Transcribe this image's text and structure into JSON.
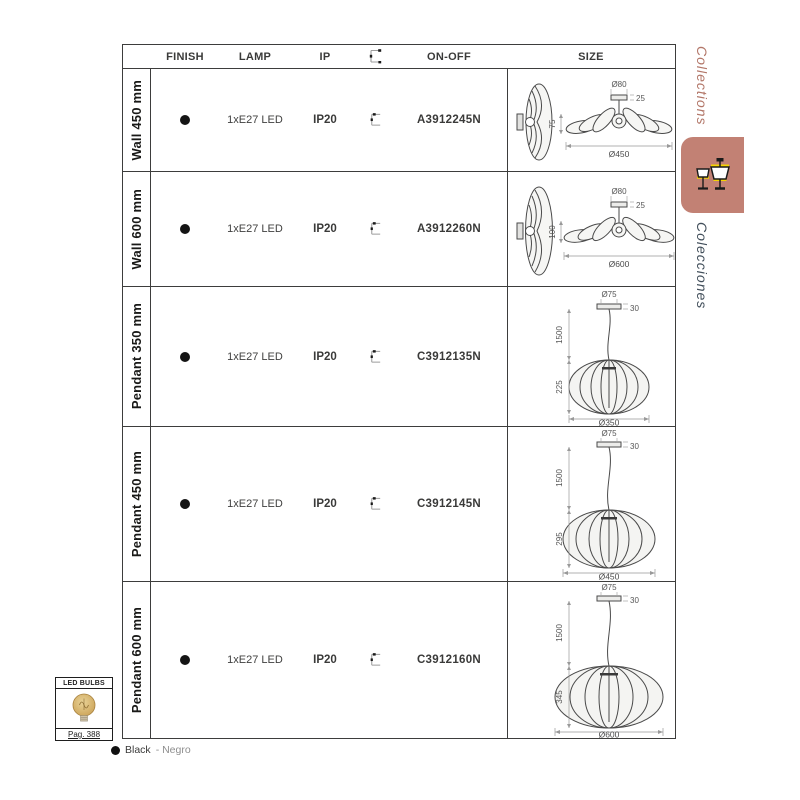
{
  "table": {
    "headers": {
      "finish": "FINISH",
      "lamp": "LAMP",
      "ip": "IP",
      "switch_icon": "switch-icon",
      "onoff": "ON-OFF",
      "size": "SIZE"
    },
    "rows": [
      {
        "label": "Wall 450 mm",
        "finish": "Black",
        "lamp": "1xE27 LED",
        "ip": "IP20",
        "code": "A3912245N",
        "dims": {
          "canopy_d": "Ø80",
          "canopy_h": "25",
          "height": "75",
          "diameter": "Ø450"
        }
      },
      {
        "label": "Wall 600 mm",
        "finish": "Black",
        "lamp": "1xE27 LED",
        "ip": "IP20",
        "code": "A3912260N",
        "dims": {
          "canopy_d": "Ø80",
          "canopy_h": "25",
          "height": "100",
          "diameter": "Ø600"
        }
      },
      {
        "label": "Pendant 350 mm",
        "finish": "Black",
        "lamp": "1xE27 LED",
        "ip": "IP20",
        "code": "C3912135N",
        "dims": {
          "canopy_d": "Ø75",
          "canopy_h": "30",
          "drop": "1500",
          "height": "225",
          "diameter": "Ø350"
        }
      },
      {
        "label": "Pendant 450 mm",
        "finish": "Black",
        "lamp": "1xE27 LED",
        "ip": "IP20",
        "code": "C3912145N",
        "dims": {
          "canopy_d": "Ø75",
          "canopy_h": "30",
          "drop": "1500",
          "height": "295",
          "diameter": "Ø450"
        }
      },
      {
        "label": "Pendant 600 mm",
        "finish": "Black",
        "lamp": "1xE27 LED",
        "ip": "IP20",
        "code": "C3912160N",
        "dims": {
          "canopy_d": "Ø75",
          "canopy_h": "30",
          "drop": "1500",
          "height": "345",
          "diameter": "Ø600"
        }
      }
    ]
  },
  "sidebar": {
    "collections_en": "Collections",
    "collections_es": "Colecciones"
  },
  "led_box": {
    "title": "LED BULBS",
    "page": "Pag. 388"
  },
  "legend": {
    "color_en": "Black",
    "color_es": "- Negro"
  },
  "colors": {
    "accent_tab": "#c28174",
    "accent_text": "#b27668",
    "side_dark_text": "#414e5a",
    "bulb_amber": "#d6b46e",
    "lamp_icon_yellow": "#f5d400"
  }
}
